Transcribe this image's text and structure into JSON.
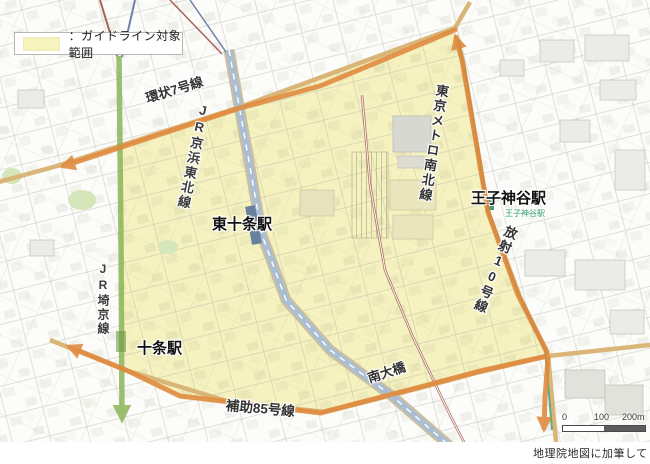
{
  "legend": {
    "label": "：ガイドライン対象範囲",
    "swatch_color": "#f6f3be"
  },
  "labels": {
    "stations": {
      "higashi_jujo": "東十条駅",
      "jujo": "十条駅",
      "oji_kamiya": "王子神谷駅",
      "oji_kamiya_small": "王子神谷駅"
    },
    "railways": {
      "jr_keihin_tohoku": "JR京浜東北線",
      "tokyo_metro_namboku": "東京メトロ南北線",
      "jr_saikyo": "JR埼京線"
    },
    "roads": {
      "kanjo_7": "環状7号線",
      "hosha_10": "放射10号線",
      "hojo_85": "補助85号線",
      "minami_ohashi": "南大橋"
    }
  },
  "scale_bar": {
    "tick_0": "0",
    "tick_100": "100",
    "tick_200": "200m"
  },
  "attribution": "地理院地図に加筆して作成",
  "colors": {
    "guideline_area_fill": "#f5f2c0",
    "boundary_arrow": "#e0893c",
    "jr_saikyo_line": "#84b24f",
    "namboku_line": "#3fa37a",
    "keihin_tohoku_rail": "#a9bdd3",
    "major_road": "#d9b678"
  }
}
